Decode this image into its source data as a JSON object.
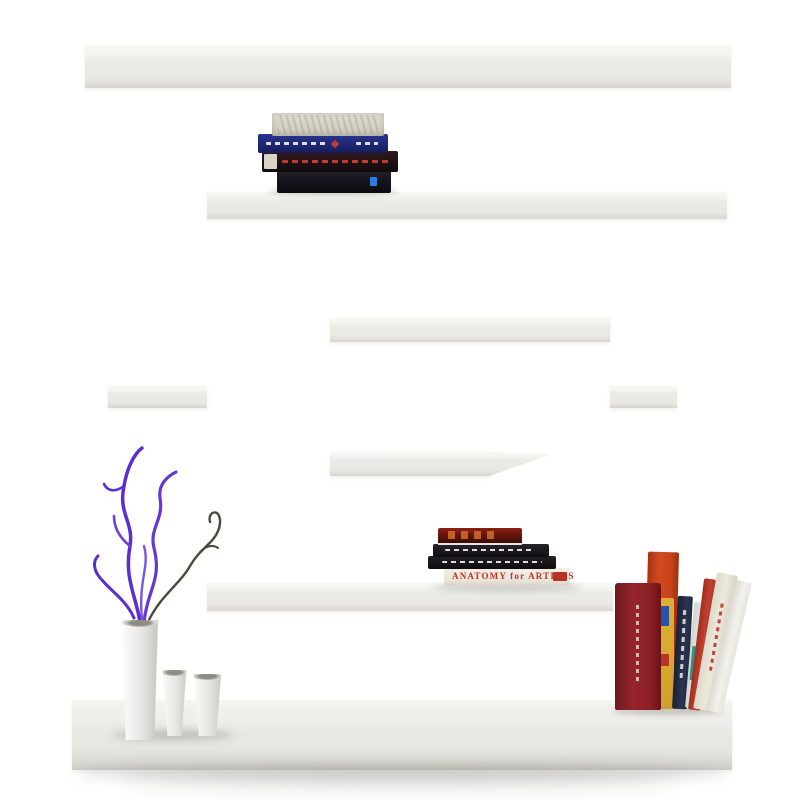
{
  "scene": {
    "type": "product-photo",
    "subject": "white maze labyrinth wall bookshelf with decor",
    "background_color": "#ffffff",
    "shelf_color": "#eaeae5",
    "shelf_edge_light": "#f7f7f3",
    "shelf_edge_dark": "#d2d1cb",
    "floor_shadow_color": "#8c8a84"
  },
  "books": {
    "top_stack": [
      {
        "name": "cream patterned book",
        "color": "#d6d2c6"
      },
      {
        "name": "navy book with white spine text",
        "color": "#232d7e",
        "accent": "#c23a34"
      },
      {
        "name": "black book with red spine text",
        "color": "#221418",
        "accent": "#c03a33"
      },
      {
        "name": "black book with blue mark",
        "color": "#15141a",
        "accent": "#2b7de0"
      }
    ],
    "middle_stack": [
      {
        "name": "dark red art book",
        "color": "#7e1a10"
      },
      {
        "name": "black book with white spine text",
        "color": "#1a171c"
      },
      {
        "name": "black book with white spine text",
        "color": "#141216"
      },
      {
        "name": "anatomy book",
        "title": "ANATOMY for ARTISTS",
        "color": "#efe9e0",
        "text_color": "#bf3126"
      }
    ],
    "right_group": [
      {
        "name": "orange book",
        "color": "#cf4a1d"
      },
      {
        "name": "maroon book with cream spine text",
        "color": "#8e2127"
      },
      {
        "name": "yellow spine book",
        "color": "#dcae35",
        "accent": "#2854a8"
      },
      {
        "name": "navy spine book",
        "color": "#27304a"
      },
      {
        "name": "white book with teal stripe",
        "color": "#d8ddd6",
        "accent": "#2f9582"
      },
      {
        "name": "red thin book",
        "color": "#bb3a2c"
      },
      {
        "name": "cream book with red spine text",
        "color": "#e9e5d8",
        "accent": "#bf3126"
      },
      {
        "name": "white leaning book",
        "color": "#f1f0ea"
      }
    ]
  },
  "decor": {
    "vases": [
      {
        "name": "tall cylinder vase",
        "color": "#eceae6"
      },
      {
        "name": "small tapered vase",
        "color": "#eceae6"
      },
      {
        "name": "small tapered vase",
        "color": "#eceae6"
      }
    ],
    "branches": {
      "purple": "#5b2ed0",
      "purple_light": "#7a55e0",
      "dark": "#4b483e"
    }
  }
}
